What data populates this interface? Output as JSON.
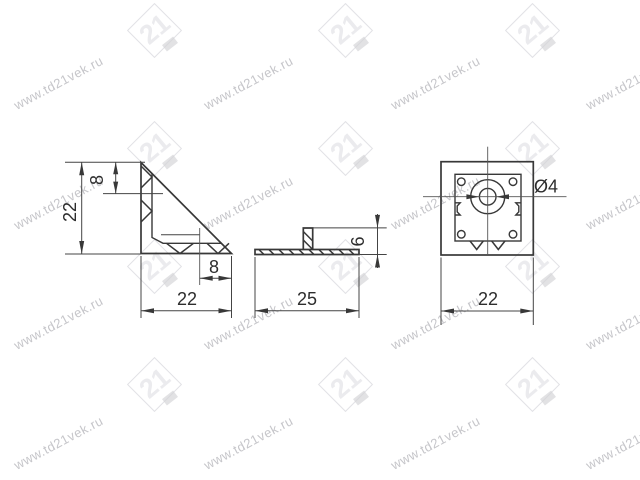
{
  "watermark": {
    "text": "www.td21vek.ru",
    "logo_text": "21",
    "text_color": "#c6c6ca",
    "logo_color": "#e2e2e6"
  },
  "drawing": {
    "side_view": {
      "height": "22",
      "top_offset": "8",
      "hole_offset": "8",
      "width": "22"
    },
    "front_view": {
      "length": "25",
      "height": "6"
    },
    "top_view": {
      "hole_diameter": "Ø4",
      "width": "22"
    }
  },
  "colors": {
    "line": "#383838",
    "dim_text": "#2d2d2d"
  }
}
